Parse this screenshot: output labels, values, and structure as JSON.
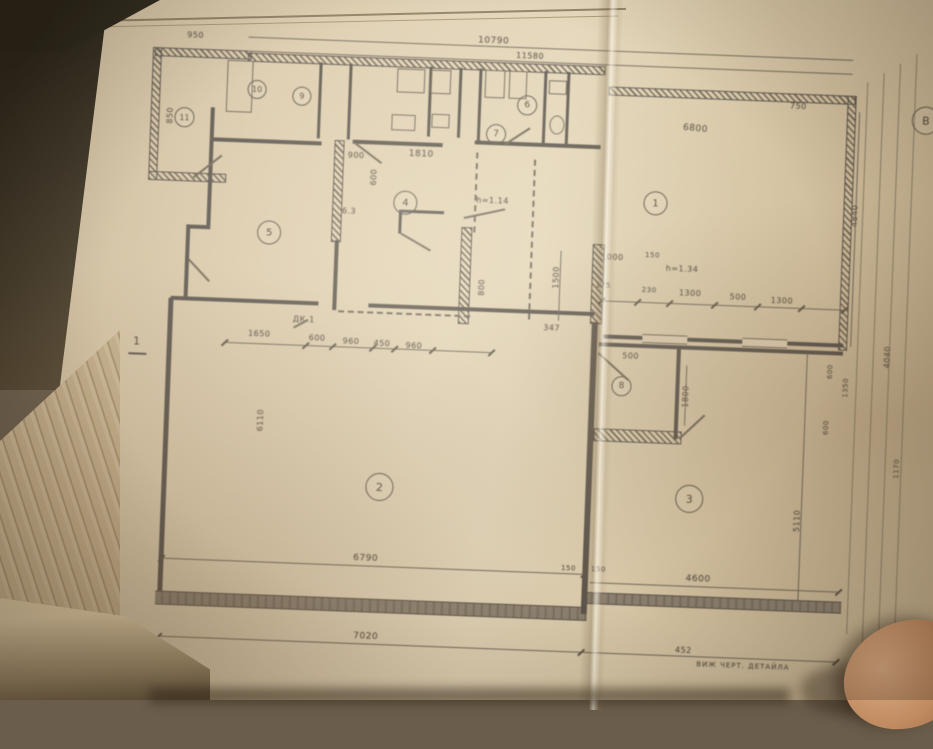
{
  "scene": {
    "description": "photograph of a hand-drafted architectural floor plan on an open book",
    "colors": {
      "paper": "#dccbad",
      "paper_shadow": "#c3ae8c",
      "ink": "#5d5346",
      "wall": "#59524a",
      "background": "#6a5d4c",
      "fabric": "#7d5c40",
      "book_cover": "#262115",
      "page_edges": "#cbb795",
      "finger_skin": "#c08a60"
    }
  },
  "plan": {
    "rooms": {
      "r1": "1",
      "r2": "2",
      "r3": "3",
      "r4": "4",
      "r5": "5",
      "r6": "6",
      "r7": "7",
      "r8": "8",
      "r9": "9",
      "r10": "10",
      "r11": "11"
    },
    "grid_marker": "B",
    "annotations": {
      "section": "1",
      "door_label": "ДК-1",
      "height_a": "h=1.14",
      "height_b": "h=1.34",
      "detail_note": "ВИЖ ЧЕРТ. ДЕТАЙЛА"
    },
    "dims": {
      "top_overall": "10790",
      "top_overall_2": "11580",
      "d950": "950",
      "d850": "850",
      "d750": "750",
      "d6800": "6800",
      "d4840": "4840",
      "d900": "900",
      "d1810": "1810",
      "d600_vert": "600",
      "d63": "6.3",
      "d800": "800",
      "c1650": "1650",
      "c600": "600",
      "c960a": "960",
      "c450": "450",
      "c960b": "960",
      "d347": "347",
      "d1500": "1500",
      "d1000": "1000",
      "d150a": "150",
      "d175": "175",
      "d230": "230",
      "d1300a": "1300",
      "d500a": "500",
      "d1300b": "1300",
      "d1800": "1800",
      "d500b": "500",
      "d6110": "6110",
      "d5110": "5110",
      "d6790": "6790",
      "d150b": "150",
      "d150c": "150",
      "d4600": "4600",
      "d7020": "7020",
      "d452": "452",
      "d600r1": "600",
      "d1350": "1350",
      "d600r2": "600",
      "d4040": "4040",
      "d1170": "1170"
    }
  }
}
